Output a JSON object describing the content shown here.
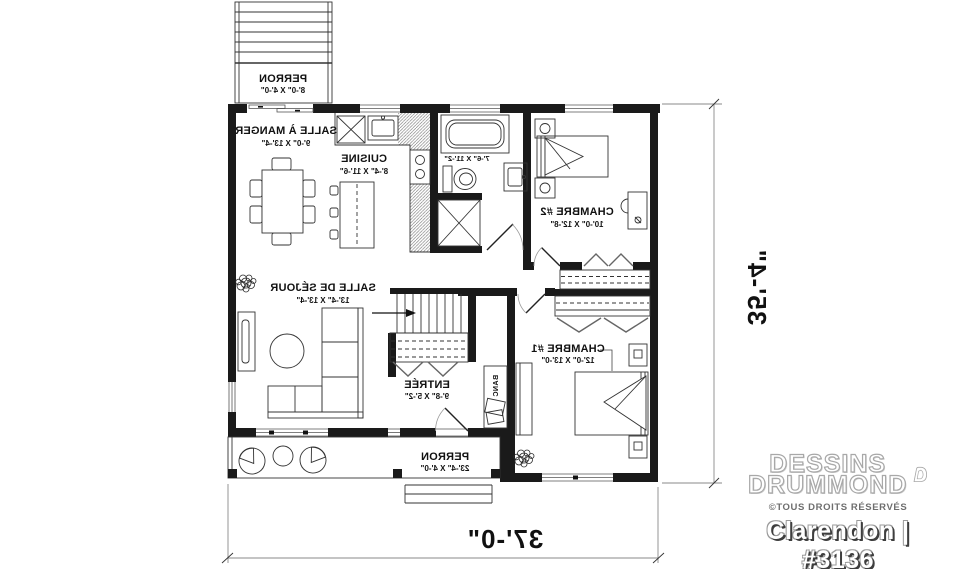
{
  "meta": {
    "background": "#ffffff",
    "wall_color": "#1a1a1a",
    "furniture_color": "#444444",
    "dim_line_color": "#8a8a8a"
  },
  "rooms": {
    "perron_top": {
      "name": "PERRON",
      "dims": "8'-0\" X 4'-0\""
    },
    "salle_a_manger": {
      "name": "SALLE À MANGER",
      "dims": "9'-0\" X 13'-4\""
    },
    "cuisine": {
      "name": "CUISINE",
      "dims": "8'-4\" X 11'-6\""
    },
    "salle_de_bain": {
      "dims": "7'-6\" X 11'-2\""
    },
    "chambre_2": {
      "name": "CHAMBRE #2",
      "dims": "10'-0\" X 12'-8\""
    },
    "salle_de_sejour": {
      "name": "SALLE DE SÉJOUR",
      "dims": "13'-4\" X 13'-4\""
    },
    "entree": {
      "name": "ENTRÉE",
      "dims": "9'-8\" X 5'-2\""
    },
    "chambre_1": {
      "name": "CHAMBRE #1",
      "dims": "12'-0\" X 13'-0\""
    },
    "banc": {
      "name": "BANC"
    },
    "perron_bottom": {
      "name": "PERRON",
      "dims": "23'-4\" X 4'-0\""
    }
  },
  "dimensions": {
    "overall_width": "37'-0\"",
    "overall_depth": "35'-4\""
  },
  "watermark": {
    "brand_top": "DESSINS",
    "brand_bottom": "DRUMMOND",
    "rights": "©TOUS DROITS RÉSERVÉS",
    "plan_name": "Clarendon | #3136"
  }
}
